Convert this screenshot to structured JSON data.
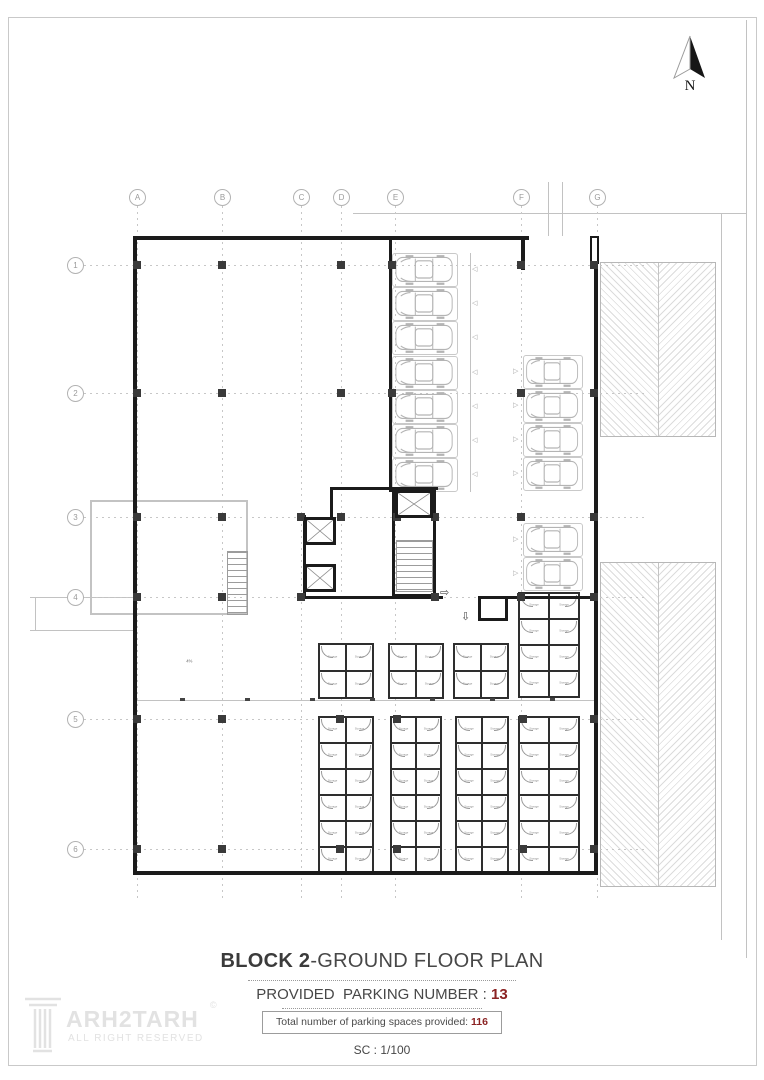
{
  "sheet": {
    "frame_color": "#c9c9c9"
  },
  "north_arrow": {
    "label": "N"
  },
  "grid": {
    "columns": [
      [
        "A",
        137
      ],
      [
        "B",
        222
      ],
      [
        "C",
        301
      ],
      [
        "D",
        341
      ],
      [
        "E",
        395
      ],
      [
        "F",
        521
      ],
      [
        "G",
        597
      ]
    ],
    "rows": [
      [
        "1",
        265
      ],
      [
        "2",
        393
      ],
      [
        "3",
        517
      ],
      [
        "4",
        597
      ],
      [
        "5",
        719
      ],
      [
        "6",
        849
      ]
    ],
    "v_top": 206,
    "v_bottom": 900,
    "h_left": 84,
    "h_right": 648,
    "label_y": 197,
    "label_x": 75
  },
  "plan": {
    "walls": [
      [
        133,
        236,
        396,
        4
      ],
      [
        521,
        236,
        4,
        34
      ],
      [
        594,
        262,
        4,
        613
      ],
      [
        133,
        236,
        4,
        639
      ],
      [
        133,
        871,
        465,
        4
      ],
      [
        389,
        236,
        3,
        256
      ],
      [
        330,
        487,
        108,
        3
      ],
      [
        330,
        487,
        3,
        30
      ],
      [
        392,
        490,
        3,
        107
      ],
      [
        433,
        490,
        3,
        107
      ],
      [
        392,
        594,
        44,
        3
      ],
      [
        303,
        515,
        3,
        84
      ],
      [
        303,
        596,
        140,
        3
      ],
      [
        478,
        596,
        119,
        3
      ],
      [
        478,
        598,
        3,
        22
      ],
      [
        478,
        618,
        30,
        3
      ],
      [
        505,
        598,
        3,
        22
      ]
    ],
    "wall_stub": [
      590,
      236,
      9,
      28
    ],
    "columns": [
      [
        137,
        265
      ],
      [
        222,
        265
      ],
      [
        341,
        265
      ],
      [
        392,
        265
      ],
      [
        521,
        265
      ],
      [
        594,
        265
      ],
      [
        137,
        393
      ],
      [
        222,
        393
      ],
      [
        341,
        393
      ],
      [
        392,
        393
      ],
      [
        521,
        393
      ],
      [
        594,
        393
      ],
      [
        137,
        517
      ],
      [
        222,
        517
      ],
      [
        301,
        517
      ],
      [
        341,
        517
      ],
      [
        397,
        517
      ],
      [
        435,
        517
      ],
      [
        521,
        517
      ],
      [
        594,
        517
      ],
      [
        137,
        597
      ],
      [
        222,
        597
      ],
      [
        301,
        597
      ],
      [
        435,
        597
      ],
      [
        521,
        597
      ],
      [
        594,
        597
      ],
      [
        137,
        719
      ],
      [
        222,
        719
      ],
      [
        340,
        719
      ],
      [
        397,
        719
      ],
      [
        523,
        719
      ],
      [
        594,
        719
      ],
      [
        137,
        849
      ],
      [
        222,
        849
      ],
      [
        340,
        849
      ],
      [
        397,
        849
      ],
      [
        523,
        849
      ],
      [
        594,
        849
      ]
    ],
    "elevators": [
      [
        304,
        517,
        32,
        28
      ],
      [
        304,
        564,
        32,
        28
      ],
      [
        395,
        490,
        38,
        28
      ]
    ],
    "stairs": [
      [
        396,
        540,
        37,
        52
      ],
      [
        227,
        551,
        21,
        64
      ]
    ],
    "ramp_outline": [
      90,
      500,
      158,
      115
    ],
    "hatch_blocks": [
      [
        600,
        262,
        116,
        175
      ],
      [
        600,
        562,
        116,
        325
      ]
    ],
    "site_lines": [
      [
        353,
        213,
        746,
        213
      ],
      [
        548,
        182,
        548,
        236
      ],
      [
        562,
        182,
        562,
        236
      ],
      [
        721,
        213,
        721,
        940
      ],
      [
        746,
        20,
        746,
        958
      ],
      [
        30,
        597,
        133,
        597
      ],
      [
        30,
        630,
        133,
        630
      ],
      [
        35,
        597,
        35,
        630
      ],
      [
        135,
        700,
        594,
        700
      ],
      [
        470,
        253,
        470,
        492
      ]
    ],
    "corridor_ticks": [
      180,
      245,
      310,
      370,
      430,
      490,
      550
    ],
    "parking": {
      "left": {
        "x": 392,
        "w": 66,
        "h": 34,
        "tops": [
          253,
          287,
          321,
          356,
          390,
          424,
          458
        ],
        "chevron_x": 472,
        "chevron": "◁"
      },
      "right": {
        "x": 523,
        "w": 60,
        "h": 34,
        "tops": [
          355,
          389,
          423,
          457,
          523,
          557
        ],
        "chevron_x": 513,
        "chevron": "▷"
      }
    },
    "storage_label": "Storage",
    "storage_groups": [
      [
        318,
        643,
        2,
        2,
        27,
        27
      ],
      [
        388,
        643,
        2,
        2,
        27,
        27
      ],
      [
        453,
        643,
        2,
        2,
        27,
        27
      ],
      [
        518,
        592,
        2,
        4,
        30,
        26
      ],
      [
        318,
        716,
        2,
        6,
        27,
        26
      ],
      [
        390,
        716,
        2,
        6,
        25,
        26
      ],
      [
        455,
        716,
        2,
        6,
        26,
        26
      ],
      [
        518,
        716,
        2,
        6,
        30,
        26
      ]
    ],
    "exit_arrows": [
      {
        "glyph": "⇨",
        "x": 440,
        "y": 586,
        "size": 11
      },
      {
        "glyph": "⇩",
        "x": 461,
        "y": 610,
        "size": 11
      }
    ],
    "slope_marker": {
      "x": 185,
      "y": 659,
      "label": "4%"
    }
  },
  "title_block": {
    "title_bold": "BLOCK 2",
    "title_rest": "-GROUND FLOOR PLAN",
    "line2_label": "PROVIDED  PARKING NUMBER : ",
    "line2_value": "13",
    "box_label": "Total number of parking spaces provided: ",
    "box_value": "116",
    "scale_text": "SC : 1/100",
    "accent_color": "#8b2323"
  },
  "logo": {
    "brand": "ARH2TARH",
    "copyright": "©",
    "tagline": "ALL RIGHT RESERVED"
  }
}
